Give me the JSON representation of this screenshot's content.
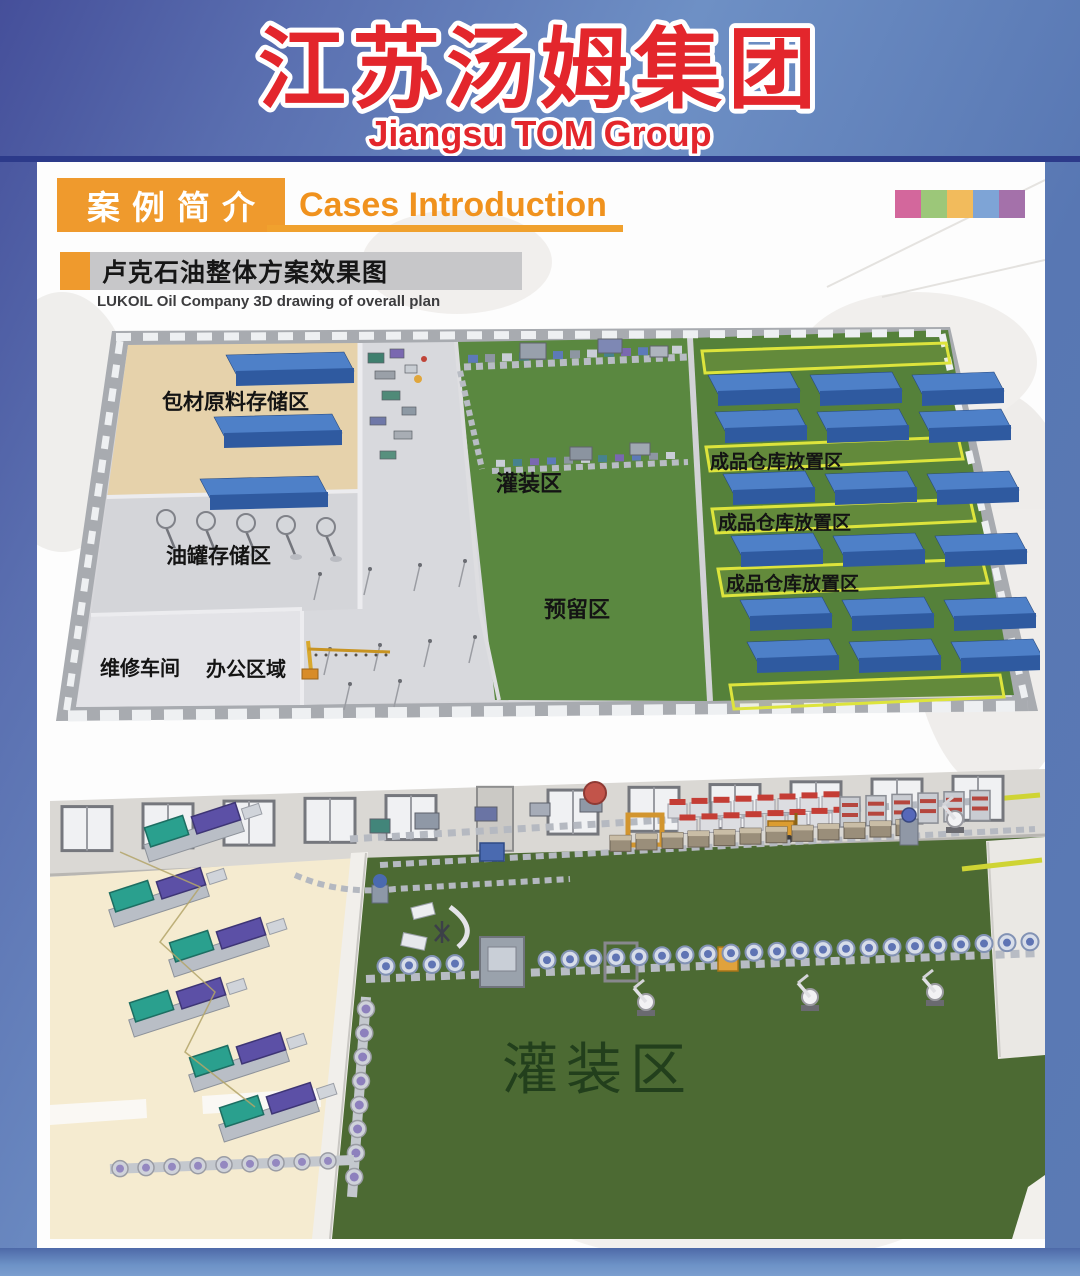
{
  "header": {
    "title_cn": "江苏汤姆集团",
    "title_en": "Jiangsu TOM Group",
    "title_color": "#e3262c"
  },
  "section_header": {
    "badge_cn": "案例简介",
    "title_en": "Cases Introduction",
    "accent_color": "#ef9a2d"
  },
  "case_banner": {
    "title_cn": "卢克石油整体方案效果图",
    "subtitle_en": "LUKOIL Oil Company 3D drawing of overall plan"
  },
  "palette_strip": {
    "colors": [
      "#d3679c",
      "#9cc779",
      "#f2bb5c",
      "#7ea4d6",
      "#a471aa"
    ]
  },
  "top_plan": {
    "zones": {
      "packaging": "包材原料存储区",
      "oil_tank": "油罐存储区",
      "maintenance": "维修车间",
      "office": "办公区域",
      "filling": "灌装区",
      "reserved": "预留区",
      "warehouse1": "成品仓库放置区",
      "warehouse2": "成品仓库放置区",
      "warehouse3": "成品仓库放置区"
    },
    "floor_colors": {
      "green": "#55813a",
      "tan": "#e6d2ab",
      "box_blue": "#4e80c8"
    }
  },
  "bottom_plan": {
    "filling": "灌装区",
    "floor_colors": {
      "green": "#4c6a33",
      "beige": "#f5ebd0"
    }
  }
}
